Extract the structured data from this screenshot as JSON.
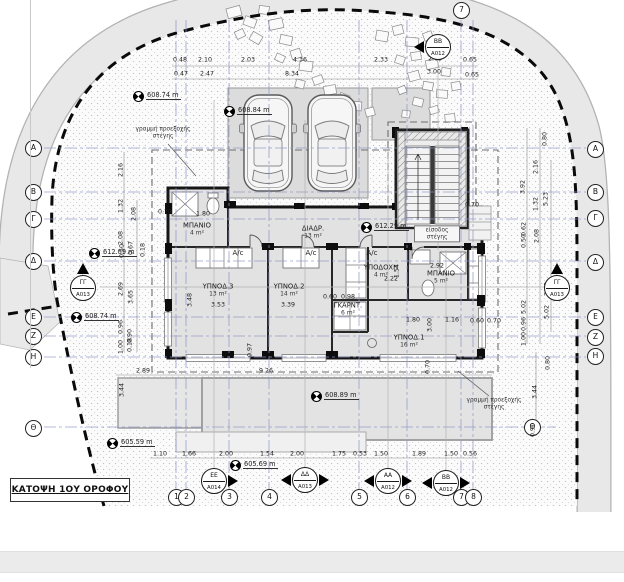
{
  "title": "ΚΑΤΟΨΗ 1ΟΥ ΟΡΟΦΟΥ",
  "colors": {
    "grid_line": "#8f97c6",
    "boundary": "#0a0a0a",
    "road_band": "#e8e8e8",
    "wall": "#161616",
    "interior_fill": "#e2e2e2",
    "footer_band": "#ebebeb"
  },
  "grid": {
    "left": [
      [
        "Α",
        33,
        148
      ],
      [
        "Β",
        33,
        192
      ],
      [
        "Γ",
        33,
        219
      ],
      [
        "Δ",
        33,
        261
      ],
      [
        "Ε",
        33,
        317
      ],
      [
        "Ζ",
        33,
        336
      ],
      [
        "Η",
        33,
        357
      ],
      [
        "Θ",
        33,
        428
      ]
    ],
    "right": [
      [
        "Α",
        595,
        149
      ],
      [
        "Β",
        595,
        192
      ],
      [
        "Γ",
        595,
        218
      ],
      [
        "Δ",
        595,
        262
      ],
      [
        "Ε",
        595,
        317
      ],
      [
        "Ζ",
        595,
        337
      ],
      [
        "Η",
        595,
        356
      ],
      [
        "Θ",
        532,
        427
      ]
    ],
    "bottom": [
      [
        "1",
        176,
        497
      ],
      [
        "2",
        186,
        497
      ],
      [
        "3",
        229,
        497
      ],
      [
        "4",
        269,
        497
      ],
      [
        "5",
        359,
        497
      ],
      [
        "6",
        407,
        497
      ],
      [
        "7",
        461,
        497
      ],
      [
        "8",
        473,
        497
      ]
    ],
    "top": [
      [
        "7",
        461,
        10
      ]
    ]
  },
  "section_markers": [
    {
      "code": "ΒΒ",
      "sheet": "A012",
      "x": 438,
      "y": 47,
      "tri": "w"
    },
    {
      "code": "ΓΓ",
      "sheet": "A013",
      "x": 83,
      "y": 288,
      "tri": "n"
    },
    {
      "code": "ΓΓ",
      "sheet": "A013",
      "x": 557,
      "y": 288,
      "tri": "n"
    },
    {
      "code": "ΕΕ",
      "sheet": "A014",
      "x": 214,
      "y": 481,
      "tri": "e"
    },
    {
      "code": "ΔΔ",
      "sheet": "A013",
      "x": 305,
      "y": 480,
      "tri": "we"
    },
    {
      "code": "ΑΑ",
      "sheet": "A012",
      "x": 388,
      "y": 481,
      "tri": "we"
    },
    {
      "code": "ΒΒ",
      "sheet": "A012",
      "x": 446,
      "y": 483,
      "tri": "we"
    }
  ],
  "elevations": [
    {
      "t": "608.74 m",
      "x": 146,
      "y": 97
    },
    {
      "t": "608.84 m",
      "x": 237,
      "y": 112
    },
    {
      "t": "612.09 m",
      "x": 102,
      "y": 254
    },
    {
      "t": "612.29 m",
      "x": 374,
      "y": 228
    },
    {
      "t": "608.74 m",
      "x": 84,
      "y": 318
    },
    {
      "t": "608.89 m",
      "x": 324,
      "y": 397
    },
    {
      "t": "605.59 m",
      "x": 120,
      "y": 444
    },
    {
      "t": "605.69 m",
      "x": 243,
      "y": 466
    }
  ],
  "rooms": [
    {
      "name": "ΜΠΑΝΙΟ",
      "area": "4 m²",
      "x": 197,
      "y": 229
    },
    {
      "name": "ΔΙΑΔΡ.",
      "area": "13 m²",
      "x": 313,
      "y": 232
    },
    {
      "name": "ΥΠΝΟΔ.3",
      "area": "13 m²",
      "x": 218,
      "y": 290
    },
    {
      "name": "ΥΠΝΟΔ.2",
      "area": "14 m²",
      "x": 289,
      "y": 290
    },
    {
      "name": "ΥΠΟΔΟΧΗ",
      "area": "4 m²",
      "x": 381,
      "y": 271
    },
    {
      "name": "ΜΠΑΝΙΟ",
      "area": "5 m²",
      "x": 441,
      "y": 277
    },
    {
      "name": "ΓΚΑΡΝΤ.",
      "area": "6 m²",
      "x": 348,
      "y": 309
    },
    {
      "name": "ΥΠΝΟΔ.1",
      "area": "16 m²",
      "x": 409,
      "y": 341
    }
  ],
  "ac_label": "A/c",
  "ac_positions": [
    [
      238,
      253
    ],
    [
      311,
      253
    ],
    [
      372,
      253
    ]
  ],
  "notes": [
    {
      "text": "γραμμή προεξοχής στέγης",
      "x": 163,
      "y": 133,
      "boxed": false
    },
    {
      "text": "γραμμή προεξοχής στέγης",
      "x": 494,
      "y": 404,
      "boxed": false
    },
    {
      "text": "είσοδος στέγης",
      "x": 437,
      "y": 234,
      "boxed": true
    }
  ],
  "dims_h": [
    [
      "0.48",
      180,
      60
    ],
    [
      "2.10",
      205,
      60
    ],
    [
      "2.03",
      248,
      60
    ],
    [
      "4.36",
      300,
      60
    ],
    [
      "2.33",
      381,
      60
    ],
    [
      "2.63",
      435,
      59
    ],
    [
      "0.65",
      470,
      60
    ],
    [
      "0.47",
      181,
      74
    ],
    [
      "2.47",
      207,
      74
    ],
    [
      "8.34",
      292,
      74
    ],
    [
      "3.00",
      434,
      72
    ],
    [
      "0.65",
      472,
      75
    ],
    [
      "2.89",
      143,
      371
    ],
    [
      "9.26",
      266,
      371
    ],
    [
      "1.10",
      160,
      454
    ],
    [
      "1.66",
      189,
      454
    ],
    [
      "2.00",
      226,
      454
    ],
    [
      "1.54",
      267,
      454
    ],
    [
      "2.00",
      297,
      454
    ],
    [
      "1.75",
      339,
      454
    ],
    [
      "0.53",
      360,
      454
    ],
    [
      "1.50",
      381,
      454
    ],
    [
      "1.89",
      419,
      454
    ],
    [
      "1.50",
      451,
      454
    ],
    [
      "0.56",
      470,
      454
    ],
    [
      "3.53",
      218,
      305
    ],
    [
      "3.39",
      288,
      305
    ],
    [
      "1.80",
      203,
      214
    ],
    [
      "1.80",
      413,
      320
    ],
    [
      "1.16",
      452,
      320
    ],
    [
      "0.60",
      330,
      297
    ],
    [
      "0.98",
      348,
      297
    ],
    [
      "2.92",
      437,
      266
    ],
    [
      "2.22",
      391,
      279
    ],
    [
      "0.70",
      472,
      205
    ],
    [
      "0.70",
      165,
      212
    ],
    [
      "0.60",
      477,
      321
    ],
    [
      "0.70",
      494,
      321
    ]
  ],
  "dims_v": [
    [
      "2.16",
      121,
      170
    ],
    [
      "1.32",
      121,
      206
    ],
    [
      "2.08",
      134,
      214
    ],
    [
      "2.08",
      121,
      238
    ],
    [
      "0.50",
      122,
      251
    ],
    [
      "0.67",
      131,
      248
    ],
    [
      "0.18",
      143,
      250
    ],
    [
      "2.69",
      121,
      289
    ],
    [
      "3.65",
      131,
      297
    ],
    [
      "0.96",
      121,
      327
    ],
    [
      "1.00",
      121,
      347
    ],
    [
      "0.90",
      130,
      336
    ],
    [
      "0.18",
      130,
      345
    ],
    [
      "3.44",
      122,
      390
    ],
    [
      "3.48",
      190,
      300
    ],
    [
      "0.97",
      250,
      350
    ],
    [
      "3.00",
      430,
      325
    ],
    [
      "0.70",
      428,
      367
    ],
    [
      "1.54",
      397,
      271
    ],
    [
      "0.80",
      545,
      139
    ],
    [
      "2.16",
      536,
      167
    ],
    [
      "3.92",
      523,
      187
    ],
    [
      "1.32",
      536,
      204
    ],
    [
      "5.23",
      546,
      199
    ],
    [
      "0.62",
      524,
      229
    ],
    [
      "0.50",
      524,
      241
    ],
    [
      "2.08",
      537,
      236
    ],
    [
      "2.69",
      547,
      289
    ],
    [
      "5.02",
      524,
      307
    ],
    [
      "5.02",
      547,
      312
    ],
    [
      "0.96",
      524,
      324
    ],
    [
      "1.00",
      524,
      339
    ],
    [
      "0.80",
      548,
      363
    ],
    [
      "3.44",
      535,
      392
    ],
    [
      "0.90",
      533,
      430
    ]
  ]
}
